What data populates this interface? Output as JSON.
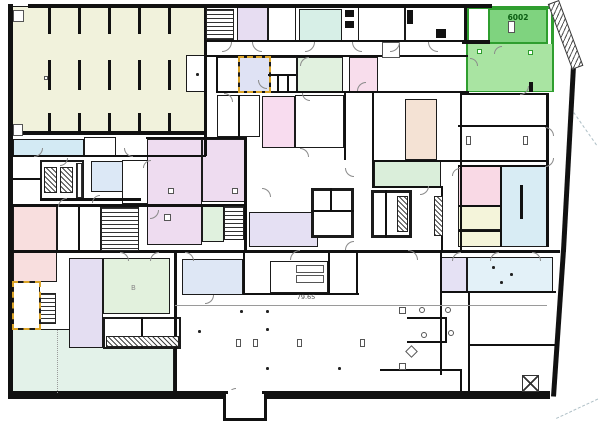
{
  "plan": {
    "labels": {
      "room_number": "6002",
      "dimension": "79.65",
      "fixture_b": "B"
    },
    "highlight": {
      "room_id": "6002",
      "border_color": "#2f9e2f",
      "zone": {
        "x": 466,
        "y": 6,
        "w": 88,
        "h": 86
      },
      "dark_room": {
        "x": 488,
        "y": 8,
        "w": 60,
        "h": 36,
        "color": "#7fd37f"
      },
      "light_room": {
        "x": 468,
        "y": 44,
        "w": 84,
        "h": 47,
        "color": "#a9e4a2"
      },
      "squares": [
        [
          477,
          49
        ],
        [
          528,
          50
        ]
      ],
      "tick": {
        "x": 529,
        "y": 82,
        "w": 4,
        "h": 10
      }
    },
    "selection_outlines": [
      {
        "x": 238,
        "y": 56,
        "w": 33,
        "h": 37
      },
      {
        "x": 12,
        "y": 281,
        "w": 29,
        "h": 49
      }
    ],
    "rooms": [
      {
        "name": "storage-hall",
        "x": 12,
        "y": 6,
        "w": 194,
        "h": 127,
        "color": "#f1f2dc"
      },
      {
        "name": "room-blue-topleft",
        "x": 13,
        "y": 139,
        "w": 71,
        "h": 17,
        "color": "#d3eaf4"
      },
      {
        "name": "room-white-topleft",
        "x": 84,
        "y": 137,
        "w": 32,
        "h": 19,
        "color": "#ffffff"
      },
      {
        "name": "room-purple-top",
        "x": 237,
        "y": 7,
        "w": 31,
        "h": 34,
        "color": "#e7ddf2"
      },
      {
        "name": "room-white-top",
        "x": 268,
        "y": 7,
        "w": 28,
        "h": 34,
        "color": "#ffffff"
      },
      {
        "name": "room-mint-top",
        "x": 299,
        "y": 9,
        "w": 43,
        "h": 32,
        "color": "#d7efe7"
      },
      {
        "name": "room-white-top2",
        "x": 358,
        "y": 7,
        "w": 47,
        "h": 34,
        "color": "#ffffff"
      },
      {
        "name": "room-white-top3",
        "x": 405,
        "y": 7,
        "w": 62,
        "h": 34,
        "color": "#ffffff"
      },
      {
        "name": "room-white-mid1",
        "x": 217,
        "y": 57,
        "w": 22,
        "h": 35,
        "color": "#ffffff"
      },
      {
        "name": "room-highlight-blue",
        "x": 239,
        "y": 57,
        "w": 31,
        "h": 35,
        "color": "#dfe2f4"
      },
      {
        "name": "room-white-mid2",
        "x": 270,
        "y": 57,
        "w": 27,
        "h": 35,
        "color": "#ffffff"
      },
      {
        "name": "room-green-midtop",
        "x": 297,
        "y": 57,
        "w": 46,
        "h": 35,
        "color": "#e1f1df"
      },
      {
        "name": "room-pink-midtop",
        "x": 349,
        "y": 57,
        "w": 29,
        "h": 35,
        "color": "#f8ddec"
      },
      {
        "name": "room-white-c1",
        "x": 217,
        "y": 95,
        "w": 43,
        "h": 42,
        "color": "#ffffff"
      },
      {
        "name": "room-pink-tall",
        "x": 262,
        "y": 96,
        "w": 33,
        "h": 52,
        "color": "#f8dcef"
      },
      {
        "name": "room-white-c2",
        "x": 295,
        "y": 95,
        "w": 49,
        "h": 53,
        "color": "#ffffff"
      },
      {
        "name": "room-tan",
        "x": 405,
        "y": 99,
        "w": 32,
        "h": 61,
        "color": "#f4e2d4"
      },
      {
        "name": "room-green-mid",
        "x": 374,
        "y": 161,
        "w": 67,
        "h": 26,
        "color": "#daeeda"
      },
      {
        "name": "room-lavender-big",
        "x": 147,
        "y": 139,
        "w": 55,
        "h": 106,
        "color": "#eedcf0"
      },
      {
        "name": "room-lavender-2",
        "x": 202,
        "y": 139,
        "w": 43,
        "h": 63,
        "color": "#eedcf0"
      },
      {
        "name": "room-green-small",
        "x": 202,
        "y": 204,
        "w": 22,
        "h": 38,
        "color": "#e0f1de"
      },
      {
        "name": "room-lavender-core",
        "x": 249,
        "y": 212,
        "w": 69,
        "h": 35,
        "color": "#e5e0f3"
      },
      {
        "name": "room-blue-left",
        "x": 91,
        "y": 161,
        "w": 32,
        "h": 31,
        "color": "#dce8f6"
      },
      {
        "name": "room-white-l2",
        "x": 122,
        "y": 160,
        "w": 26,
        "h": 44,
        "color": "#ffffff"
      },
      {
        "name": "room-pink-left",
        "x": 13,
        "y": 206,
        "w": 44,
        "h": 76,
        "color": "#f8dede"
      },
      {
        "name": "room-white-l1",
        "x": 57,
        "y": 205,
        "w": 44,
        "h": 46,
        "color": "#ffffff"
      },
      {
        "name": "room-white-sel",
        "x": 13,
        "y": 282,
        "w": 27,
        "h": 47,
        "color": "#ffffff"
      },
      {
        "name": "room-mint-big",
        "x": 12,
        "y": 329,
        "w": 162,
        "h": 64,
        "color": "#e3f2e9"
      },
      {
        "name": "room-purple-bottom",
        "x": 69,
        "y": 258,
        "w": 34,
        "h": 90,
        "color": "#e4def2"
      },
      {
        "name": "room-green-b",
        "x": 103,
        "y": 258,
        "w": 67,
        "h": 56,
        "color": "#e2f1dd"
      },
      {
        "name": "room-blue-bottom",
        "x": 182,
        "y": 259,
        "w": 61,
        "h": 36,
        "color": "#dee7f5"
      },
      {
        "name": "room-furniture",
        "x": 270,
        "y": 261,
        "w": 58,
        "h": 32,
        "color": "#ffffff"
      },
      {
        "name": "room-lavender-br",
        "x": 441,
        "y": 257,
        "w": 26,
        "h": 35,
        "color": "#e5e1f4"
      },
      {
        "name": "room-blue-br",
        "x": 467,
        "y": 257,
        "w": 86,
        "h": 35,
        "color": "#e3f1f8"
      },
      {
        "name": "room-pink-right",
        "x": 458,
        "y": 166,
        "w": 43,
        "h": 40,
        "color": "#f9d9e5"
      },
      {
        "name": "room-blue-right",
        "x": 500,
        "y": 166,
        "w": 47,
        "h": 81,
        "color": "#d8ecf4"
      },
      {
        "name": "room-yellow-r1",
        "x": 458,
        "y": 206,
        "w": 43,
        "h": 24,
        "color": "#f4f4da"
      },
      {
        "name": "room-yellow-r2",
        "x": 458,
        "y": 230,
        "w": 43,
        "h": 17,
        "color": "#f4f4da"
      },
      {
        "name": "room-storage-sub",
        "x": 186,
        "y": 55,
        "w": 20,
        "h": 37,
        "color": "#ffffff"
      },
      {
        "name": "core-left",
        "x": 311,
        "y": 188,
        "w": 43,
        "h": 50,
        "color": "#ffffff",
        "bw": 3
      },
      {
        "name": "core-right",
        "x": 371,
        "y": 190,
        "w": 41,
        "h": 48,
        "color": "#ffffff",
        "bw": 3
      },
      {
        "name": "elevator-block",
        "x": 40,
        "y": 160,
        "w": 44,
        "h": 40,
        "color": "#ffffff",
        "bw": 2.5
      },
      {
        "name": "toilet-block",
        "x": 103,
        "y": 317,
        "w": 78,
        "h": 32,
        "color": "#ffffff",
        "bw": 2
      }
    ],
    "walls": [
      [
        8,
        4,
        5,
        391
      ],
      [
        28,
        4,
        464,
        4
      ],
      [
        8,
        391,
        542,
        8
      ],
      [
        204,
        4,
        3,
        152
      ],
      [
        12,
        131,
        194,
        4
      ],
      [
        12,
        155,
        194,
        2
      ],
      [
        146,
        137,
        100,
        2
      ],
      [
        244,
        137,
        3,
        116
      ],
      [
        12,
        204,
        234,
        3
      ],
      [
        204,
        40,
        264,
        2
      ],
      [
        204,
        55,
        264,
        2
      ],
      [
        216,
        91,
        253,
        2
      ],
      [
        216,
        55,
        2,
        38
      ],
      [
        464,
        8,
        3,
        33
      ],
      [
        462,
        40,
        28,
        4
      ],
      [
        460,
        93,
        88,
        2
      ],
      [
        460,
        93,
        2,
        160
      ],
      [
        546,
        93,
        3,
        154
      ],
      [
        458,
        125,
        90,
        2
      ],
      [
        458,
        165,
        90,
        2
      ],
      [
        458,
        205,
        44,
        2
      ],
      [
        458,
        230,
        44,
        2
      ],
      [
        500,
        165,
        2,
        82
      ],
      [
        372,
        93,
        2,
        95
      ],
      [
        344,
        93,
        2,
        67
      ],
      [
        372,
        160,
        176,
        2
      ],
      [
        372,
        186,
        71,
        2
      ],
      [
        441,
        186,
        2,
        66
      ],
      [
        12,
        250,
        548,
        3
      ],
      [
        40,
        198,
        101,
        3
      ],
      [
        13,
        178,
        28,
        2
      ],
      [
        78,
        205,
        2,
        46
      ],
      [
        174,
        250,
        3,
        143
      ],
      [
        243,
        253,
        2,
        42
      ],
      [
        328,
        253,
        2,
        40
      ],
      [
        356,
        253,
        2,
        40
      ],
      [
        243,
        293,
        116,
        2
      ],
      [
        440,
        253,
        2,
        122
      ],
      [
        440,
        291,
        116,
        2
      ],
      [
        468,
        291,
        2,
        102
      ],
      [
        468,
        344,
        88,
        2
      ],
      [
        380,
        369,
        82,
        2
      ],
      [
        460,
        369,
        2,
        24
      ],
      [
        268,
        74,
        28,
        2
      ],
      [
        277,
        75,
        2,
        17
      ],
      [
        287,
        75,
        2,
        17
      ],
      [
        311,
        210,
        43,
        2
      ],
      [
        330,
        188,
        2,
        24
      ],
      [
        385,
        190,
        2,
        48
      ],
      [
        238,
        95,
        2,
        42
      ],
      [
        141,
        317,
        2,
        31
      ],
      [
        219,
        9,
        2,
        31
      ],
      [
        119,
        207,
        2,
        44
      ],
      [
        407,
        317,
        40,
        2
      ],
      [
        445,
        317,
        2,
        26
      ],
      [
        407,
        341,
        40,
        2
      ],
      [
        520,
        185,
        3,
        34
      ],
      [
        529,
        82,
        4,
        10
      ]
    ],
    "thin_lines": [
      {
        "x": 175,
        "y": 305,
        "w": 372,
        "h": 1,
        "dash": false
      },
      {
        "x": 57,
        "y": 330,
        "w": 1,
        "h": 63,
        "dash": true
      }
    ],
    "hatches": [
      [
        206,
        9,
        28,
        31,
        "h"
      ],
      [
        101,
        207,
        38,
        44,
        "h"
      ],
      [
        224,
        206,
        20,
        34,
        "h"
      ],
      [
        40,
        293,
        16,
        31,
        "h"
      ],
      [
        44,
        167,
        13,
        26,
        "d"
      ],
      [
        60,
        167,
        13,
        26,
        "d"
      ],
      [
        76,
        163,
        7,
        35,
        "v"
      ],
      [
        397,
        196,
        11,
        36,
        "d"
      ],
      [
        434,
        196,
        9,
        40,
        "d"
      ],
      [
        106,
        336,
        73,
        11,
        "d"
      ],
      [
        232,
        405,
        26,
        9,
        "v"
      ]
    ],
    "diag_walls": [
      {
        "x": 552,
        "y": 3,
        "len": 68,
        "th": 4,
        "ang": 69.6
      },
      {
        "x": 576,
        "y": 66,
        "len": 186,
        "th": 5,
        "ang": 93.1
      },
      {
        "x": 566,
        "y": 250,
        "len": 147,
        "th": 5,
        "ang": 93.9
      }
    ],
    "diag_hatch": [
      {
        "x": 559,
        "y": 0,
        "len": 70,
        "th": 12,
        "ang": 69.6
      }
    ],
    "dash_lines": [
      {
        "x": 574,
        "y": 112,
        "len": 40,
        "ang": 55
      },
      {
        "x": 556,
        "y": 418,
        "len": 46,
        "ang": -25
      }
    ],
    "stall_rows": [
      {
        "y": 8,
        "h": 26
      },
      {
        "y": 60,
        "h": 30
      },
      {
        "y": 113,
        "h": 20
      }
    ],
    "stall_xs": [
      48,
      78,
      108,
      138,
      168
    ],
    "symbols": {
      "black_boxes": [
        [
          345,
          10,
          9,
          7
        ],
        [
          345,
          21,
          9,
          7
        ],
        [
          407,
          10,
          6,
          14
        ],
        [
          436,
          29,
          10,
          9
        ]
      ],
      "outline_boxes": [
        [
          382,
          42,
          18,
          16
        ],
        [
          466,
          136,
          5,
          9
        ],
        [
          523,
          136,
          5,
          9
        ],
        [
          296,
          265,
          28,
          8
        ],
        [
          296,
          275,
          28,
          8
        ],
        [
          236,
          339,
          5,
          8
        ],
        [
          253,
          339,
          5,
          8
        ],
        [
          297,
          339,
          5,
          8
        ],
        [
          360,
          339,
          5,
          8
        ],
        [
          399,
          307,
          7,
          7
        ],
        [
          399,
          363,
          7,
          7
        ],
        [
          44,
          76,
          4,
          4
        ],
        [
          168,
          188,
          6,
          6
        ],
        [
          164,
          214,
          7,
          7
        ],
        [
          232,
          188,
          6,
          6
        ],
        [
          13,
          10,
          11,
          12
        ],
        [
          13,
          124,
          10,
          12
        ],
        [
          508,
          21,
          7,
          12
        ]
      ],
      "dots": [
        [
          196,
          73
        ],
        [
          198,
          330
        ],
        [
          266,
          310
        ],
        [
          266,
          328
        ],
        [
          266,
          367
        ],
        [
          338,
          367
        ],
        [
          240,
          310
        ],
        [
          492,
          266
        ],
        [
          510,
          273
        ],
        [
          500,
          281
        ]
      ],
      "circles": [
        [
          419,
          307
        ],
        [
          445,
          307
        ],
        [
          421,
          332
        ],
        [
          448,
          330
        ]
      ],
      "diamonds": [
        [
          407,
          347,
          9
        ]
      ],
      "xboxes": [
        [
          522,
          375,
          17,
          17
        ]
      ]
    },
    "arcs": [
      [
        222,
        42,
        10,
        "br"
      ],
      [
        252,
        42,
        10,
        "bl"
      ],
      [
        305,
        42,
        10,
        "br"
      ],
      [
        352,
        42,
        10,
        "bl"
      ],
      [
        390,
        42,
        10,
        "br"
      ],
      [
        428,
        42,
        10,
        "bl"
      ],
      [
        224,
        93,
        9,
        "tr"
      ],
      [
        258,
        80,
        9,
        "bl"
      ],
      [
        300,
        57,
        9,
        "tl"
      ],
      [
        357,
        82,
        9,
        "tl"
      ],
      [
        302,
        93,
        8,
        "bl"
      ],
      [
        300,
        148,
        9,
        "tr"
      ],
      [
        345,
        168,
        9,
        "bl"
      ],
      [
        262,
        188,
        9,
        "tr"
      ],
      [
        420,
        186,
        9,
        "br"
      ],
      [
        290,
        250,
        10,
        "tl"
      ],
      [
        345,
        241,
        9,
        "tl"
      ],
      [
        408,
        250,
        10,
        "tr"
      ],
      [
        452,
        252,
        9,
        "tl"
      ],
      [
        490,
        252,
        9,
        "tl"
      ],
      [
        532,
        252,
        9,
        "tr"
      ],
      [
        58,
        198,
        9,
        "tl"
      ],
      [
        92,
        195,
        8,
        "tl"
      ],
      [
        124,
        148,
        9,
        "bl"
      ],
      [
        34,
        148,
        9,
        "br"
      ],
      [
        60,
        158,
        8,
        "br"
      ],
      [
        143,
        160,
        8,
        "tl"
      ],
      [
        120,
        252,
        9,
        "tr"
      ],
      [
        150,
        252,
        9,
        "tl"
      ],
      [
        185,
        252,
        9,
        "tr"
      ],
      [
        205,
        295,
        9,
        "br"
      ],
      [
        150,
        210,
        9,
        "br"
      ],
      [
        545,
        127,
        9,
        "tr"
      ],
      [
        545,
        158,
        9,
        "br"
      ],
      [
        452,
        168,
        8,
        "tl"
      ],
      [
        494,
        46,
        8,
        "tl"
      ],
      [
        520,
        86,
        9,
        "br"
      ],
      [
        470,
        58,
        8,
        "tr"
      ],
      [
        228,
        388,
        8,
        "tl"
      ]
    ],
    "vestibule": {
      "x": 223,
      "y": 391,
      "w": 44,
      "h": 30,
      "open": {
        "x": 228,
        "y": 390,
        "w": 34,
        "h": 4
      }
    }
  }
}
